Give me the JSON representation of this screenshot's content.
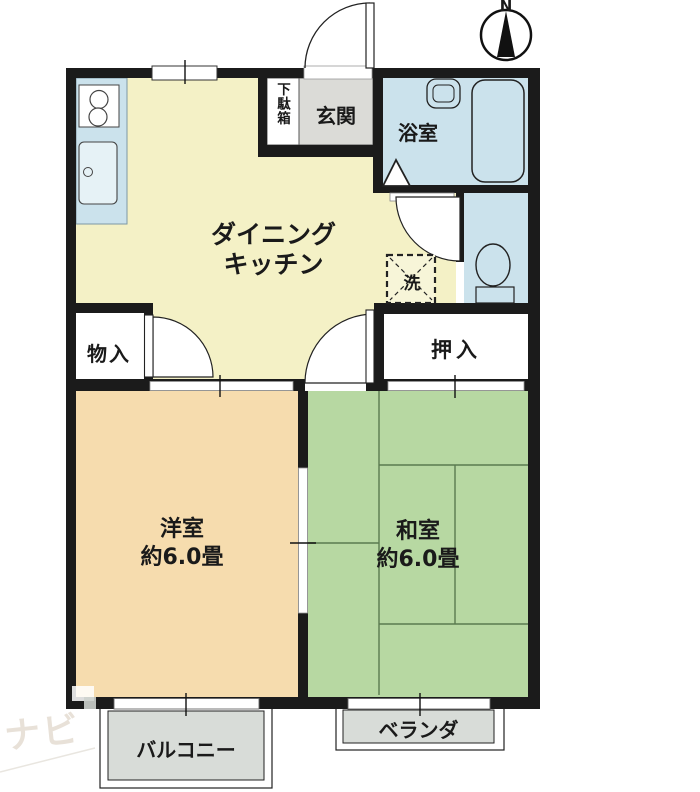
{
  "compass": {
    "north_label": "N"
  },
  "rooms": {
    "dining_kitchen": {
      "label_line1": "ダイニング",
      "label_line2": "キッチン"
    },
    "entrance": {
      "label": "玄関"
    },
    "shoe_cabinet": {
      "label": "下駄箱"
    },
    "bathroom": {
      "label": "浴室"
    },
    "laundry_space": {
      "label": "洗"
    },
    "closet": {
      "label": "押入"
    },
    "storage": {
      "label": "物入"
    },
    "western_room": {
      "label": "洋室",
      "size": "約6.0畳"
    },
    "japanese_room": {
      "label": "和室",
      "size": "約6.0畳"
    },
    "balcony": {
      "label": "バルコニー"
    },
    "veranda": {
      "label": "ベランダ"
    }
  },
  "colors": {
    "dining_kitchen": "#f4f1c6",
    "western_room": "#f6dcae",
    "japanese_room": "#b7d8a2",
    "water_area": "#cbe2ec",
    "entrance_floor": "#dbdbd7",
    "outdoor_floor": "#d8dcd8",
    "wall": "#1b1b1b"
  },
  "watermark": {
    "text": "ナビ"
  }
}
